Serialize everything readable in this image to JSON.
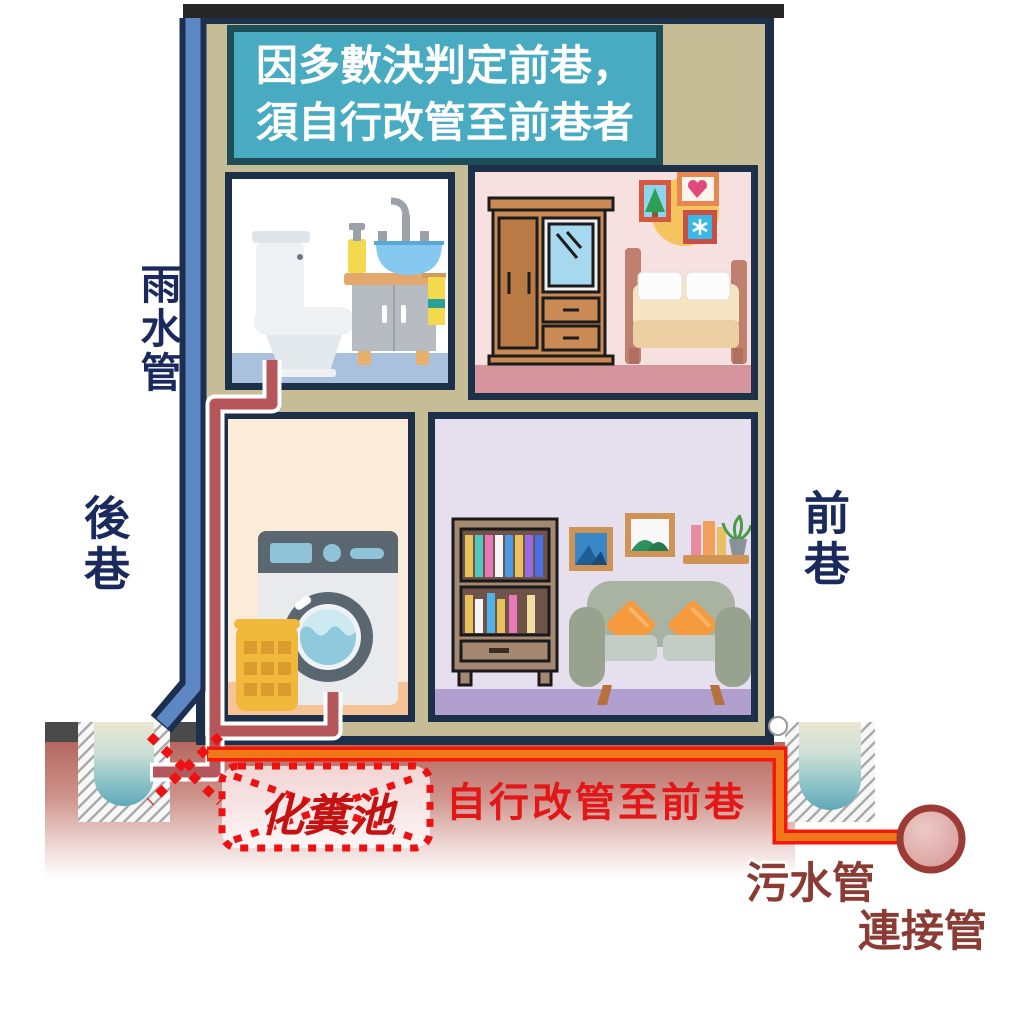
{
  "banner": {
    "line1": "因多數決判定前巷，",
    "line2": "須自行改管至前巷者"
  },
  "labels": {
    "rain_pipe": "雨水管",
    "back_alley": "後巷",
    "front_alley": "前巷",
    "septic_tank": "化糞池",
    "reroute_note": "自行改管至前巷",
    "sewage_pipe": "污水管",
    "connection_pipe": "連接管"
  },
  "colors": {
    "banner_bg": "#49abc2",
    "banner_border": "#1d4d57",
    "house_wall": "#c6bd97",
    "house_border": "#1d3049",
    "rain_pipe_blue": "#5d87c3",
    "old_sewage_pipe_red": "#b5575a",
    "new_pipe_orange": "#ef7918",
    "new_pipe_border_red": "#f51808",
    "alert_dotted_red": "#ee1111",
    "label_navy": "#1a2a5c",
    "label_maroon": "#8a3b33",
    "ground_pink": "#b4685f"
  },
  "rooms": [
    {
      "id": "bathroom",
      "items": [
        "toilet",
        "vanity-sink"
      ]
    },
    {
      "id": "bedroom",
      "items": [
        "wardrobe-mirror",
        "wall-art",
        "bed"
      ]
    },
    {
      "id": "laundry",
      "items": [
        "laundry-basket",
        "washing-machine"
      ]
    },
    {
      "id": "living-room",
      "items": [
        "bookshelf",
        "picture-frames",
        "wall-shelf",
        "sofa"
      ]
    }
  ]
}
